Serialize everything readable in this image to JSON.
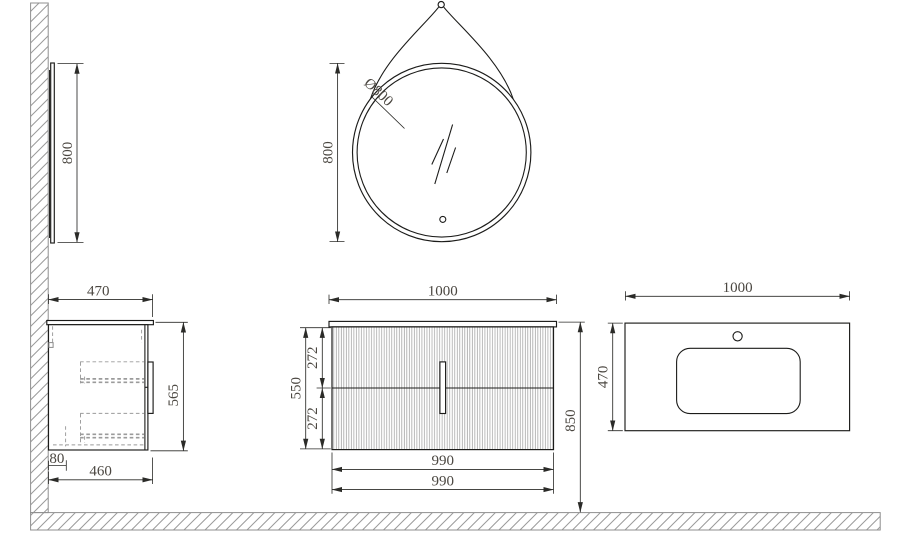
{
  "views": {
    "mirror_side": {
      "height": "800"
    },
    "mirror_front": {
      "diameter": "Ø800",
      "height": "800"
    },
    "vanity_side": {
      "depth": "470",
      "height": "565",
      "wall_gap": "80",
      "body_depth": "460"
    },
    "vanity_front": {
      "width": "1000",
      "front_height": "550",
      "upper_drawer": "272",
      "lower_drawer": "272",
      "install_height": "850",
      "width_top": "990",
      "width_bottom": "990"
    },
    "countertop_plan": {
      "width": "1000",
      "depth": "470"
    }
  },
  "colors": {
    "line": "#1c1c1a",
    "dimension_text": "#4b4741",
    "hatch": "#9a9a9a",
    "flute": "#9d9d9d",
    "background": "#ffffff"
  }
}
